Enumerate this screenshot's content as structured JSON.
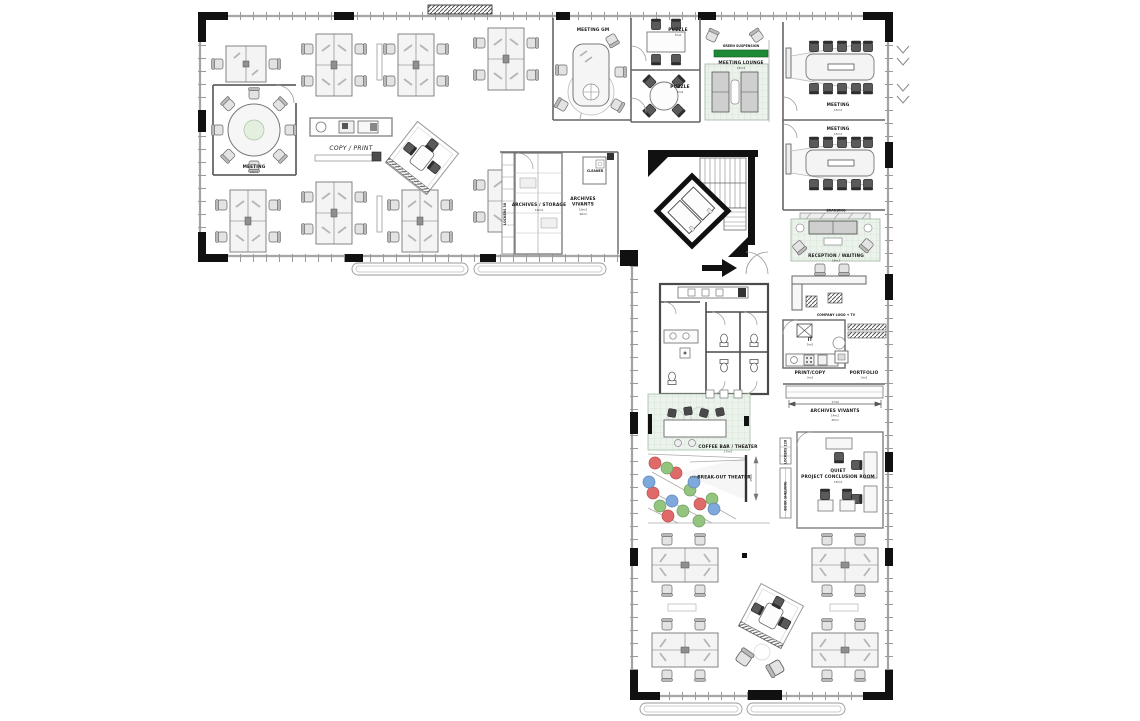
{
  "plan": {
    "background": "#ffffff",
    "accent_green": "#1e8a36",
    "pouf_colors": {
      "red": "#e06a6a",
      "green": "#94c47e",
      "blue": "#7fa9dc"
    }
  },
  "rooms": {
    "meeting_small": {
      "name": "MEETING",
      "area": "10m2"
    },
    "copy_print": {
      "name": "COPY / PRINT"
    },
    "meeting_gm": {
      "name": "MEETING GM"
    },
    "puzzle_top": {
      "name": "PUZZLE",
      "area": "5m2"
    },
    "puzzle_bottom": {
      "name": "PUZZLE",
      "area": "5m2"
    },
    "green_suspension": {
      "name": "GREEN SUSPENSION"
    },
    "meeting_lounge": {
      "name": "MEETING LOUNGE",
      "area": "15m2"
    },
    "meeting_right_top": {
      "name": "MEETING",
      "area": "15m2"
    },
    "meeting_right_bottom": {
      "name": "MEETING",
      "area": "15m2"
    },
    "branding": {
      "name": "BRANDING"
    },
    "reception": {
      "name": "RECEPTION / WAITING",
      "area": "18m2"
    },
    "company_logo": {
      "name": "COMPANY LOGO + TV"
    },
    "it": {
      "name": "IT",
      "area": "5m2"
    },
    "print_copy": {
      "name": "PRINT/COPY",
      "area": "3m2"
    },
    "portfolio": {
      "name": "PORTFOLIO",
      "area": "3m2"
    },
    "archives_band": {
      "name": "ARCHIVES VIVANTS",
      "area": "14m2",
      "length": "45ml"
    },
    "archives_storage": {
      "name": "ARCHIVES / STORAGE",
      "area": "10m2"
    },
    "archives_mid": {
      "line1": "ARCHIVES",
      "line2": "VIVANTS",
      "area": "10m2",
      "length": "40ml"
    },
    "cleaner": {
      "name": "CLEANER"
    },
    "lockers_mid": {
      "name": "LOCKERS 30"
    },
    "coffee_bar": {
      "name": "COFFEE BAR / THEATER",
      "area": "17m2"
    },
    "breakout": {
      "name": "BREAK-OUT THEATER",
      "area": "17m2"
    },
    "lockers_low": {
      "name": "LOCKERS 120"
    },
    "book_shelving": {
      "name": "BOOK SHELVING"
    },
    "quiet": {
      "line1": "QUIET",
      "line2": "PROJECT CONCLUSION ROOM",
      "area": "15m2"
    }
  },
  "annotations": {
    "dim_archives": "1744",
    "dim_screen": "3500"
  }
}
